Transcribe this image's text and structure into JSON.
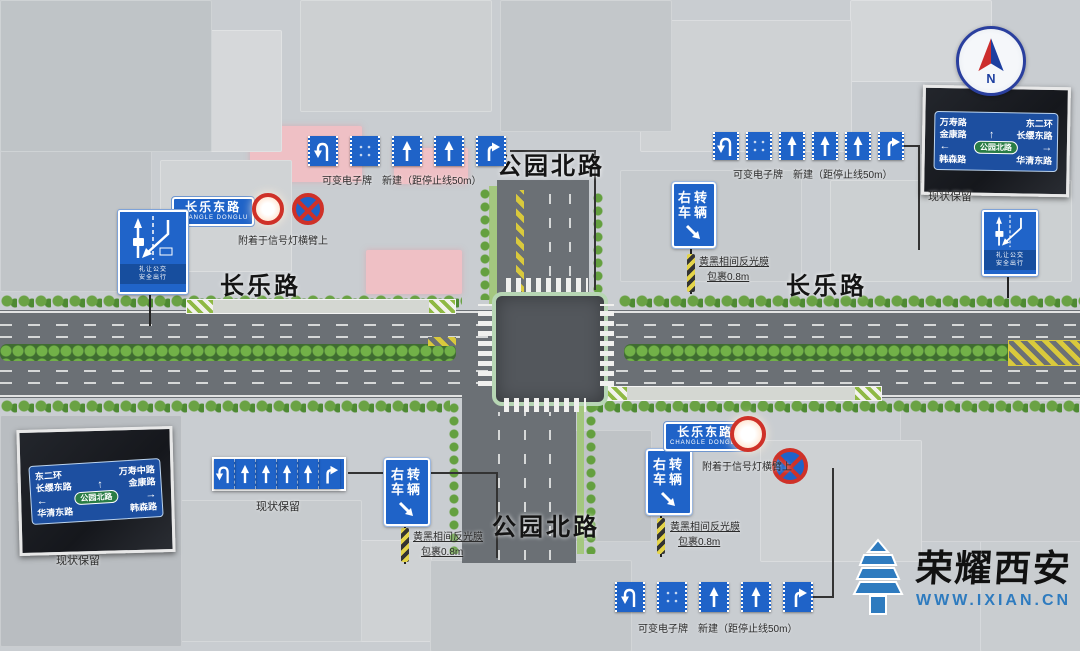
{
  "road_labels": {
    "park_north_top": "公园北路",
    "park_north_bottom": "公园北路",
    "changle_left": "长乐路",
    "changle_right": "长乐路"
  },
  "lane_sign_clusters": [
    {
      "position": "top-left",
      "arrows": [
        "uturn-left",
        "blank",
        "straight",
        "straight",
        "right"
      ],
      "caption": "可变电子牌　新建（距停止线50m）"
    },
    {
      "position": "top-right",
      "arrows": [
        "uturn-left",
        "blank",
        "straight",
        "straight",
        "straight",
        "right"
      ],
      "caption": "可变电子牌　新建（距停止线50m）"
    },
    {
      "position": "bottom-left",
      "arrows": [
        "uturn-left",
        "straight",
        "straight",
        "straight",
        "straight",
        "right"
      ],
      "caption": "现状保留"
    },
    {
      "position": "bottom-center",
      "arrows": [
        "uturn-left",
        "blank",
        "straight",
        "straight",
        "right"
      ],
      "caption": "可变电子牌　新建（距停止线50m）"
    }
  ],
  "right_turn_signs": [
    {
      "position": "north-east",
      "line1": "右转",
      "line2": "车辆",
      "caption_line1": "黄黑相间反光膜",
      "caption_line2": "包裹0.8m"
    },
    {
      "position": "south-west",
      "line1": "右转",
      "line2": "车辆",
      "caption_line1": "黄黑相间反光膜",
      "caption_line2": "包裹0.8m"
    },
    {
      "position": "south-east",
      "line1": "右转",
      "line2": "车辆",
      "caption_line1": "黄黑相间反光膜",
      "caption_line2": "包裹0.8m"
    }
  ],
  "street_plates": [
    {
      "position": "west",
      "cn": "长乐东路",
      "en": "CHANGLE DONGLU",
      "caption": "附着于信号灯横臂上"
    },
    {
      "position": "south-east",
      "cn": "长乐东路",
      "en": "CHANGLE DONGLU",
      "caption": "附着于信号灯横臂上"
    }
  ],
  "bus_lane_signs": [
    {
      "position": "west",
      "text_line1": "礼让公交",
      "text_line2": "安全出行"
    },
    {
      "position": "east",
      "text_line1": "礼让公交",
      "text_line2": "安全出行"
    }
  ],
  "guide_sign_photos": [
    {
      "position": "south-west",
      "row1_left": "东二环",
      "row1_right": "万寿中路",
      "row2_left": "长缨东路",
      "row2_right": "金康路",
      "center": "公园北路",
      "row4_left": "华清东路",
      "row4_right": "韩森路",
      "caption": "现状保留"
    },
    {
      "position": "north-east",
      "row1_left": "万寿路",
      "row1_right": "东二环",
      "row2_left": "金康路",
      "row2_right": "长缨东路",
      "center": "公园北路",
      "row4_left": "韩森路",
      "row4_right": "华清东路",
      "caption": "现状保留"
    }
  ],
  "compass": {
    "label": "N"
  },
  "watermark": {
    "brand": "荣耀西安",
    "site": "WWW.IXIAN.CN"
  }
}
